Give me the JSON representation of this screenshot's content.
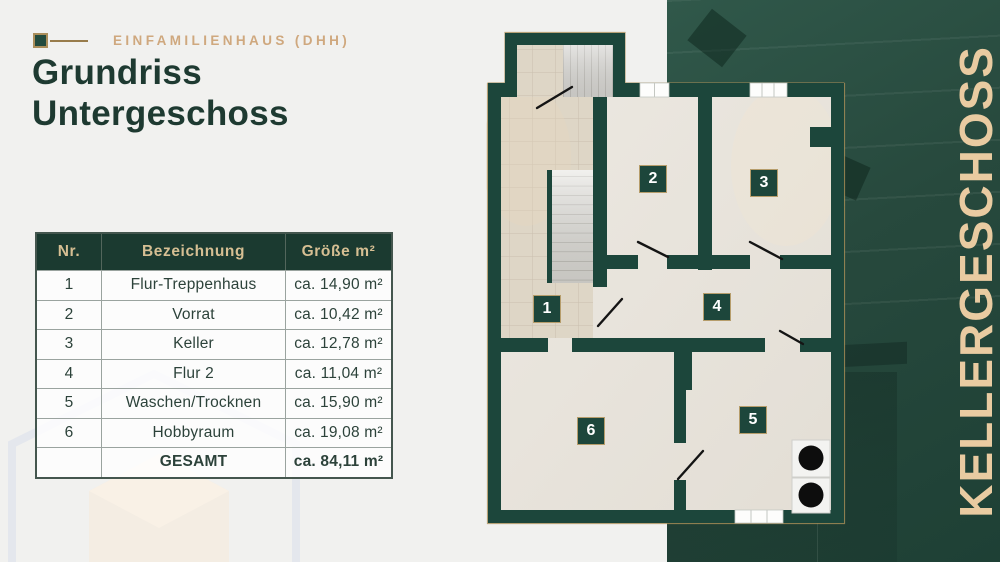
{
  "header": {
    "eyebrow": "EINFAMILIENHAUS (DHH)",
    "title_line1": "Grundriss",
    "title_line2": "Untergeschoss"
  },
  "table": {
    "columns": [
      "Nr.",
      "Bezeichnung",
      "Größe m²"
    ],
    "rows": [
      {
        "nr": "1",
        "name": "Flur-Treppenhaus",
        "size": "ca. 14,90 m²"
      },
      {
        "nr": "2",
        "name": "Vorrat",
        "size": "ca. 10,42 m²"
      },
      {
        "nr": "3",
        "name": "Keller",
        "size": "ca. 12,78 m²"
      },
      {
        "nr": "4",
        "name": "Flur 2",
        "size": "ca. 11,04 m²"
      },
      {
        "nr": "5",
        "name": "Waschen/Trocknen",
        "size": "ca. 15,90 m²"
      },
      {
        "nr": "6",
        "name": "Hobbyraum",
        "size": "ca. 19,08 m²"
      }
    ],
    "total": {
      "label": "GESAMT",
      "size": "ca. 84,11 m²"
    }
  },
  "floor_plan": {
    "rooms": [
      {
        "number": "1"
      },
      {
        "number": "2"
      },
      {
        "number": "3"
      },
      {
        "number": "4"
      },
      {
        "number": "5"
      },
      {
        "number": "6"
      }
    ]
  },
  "side_banner": {
    "text": "KELLERGESCHOSS"
  },
  "colors": {
    "wall_green": "#1c463b",
    "title_green": "#1e3a31",
    "table_header_bg": "#1b3a30",
    "gold_eyebrow": "#cfa87e",
    "gold_banner": "#e9cba1",
    "gold_outline": "#a98e58",
    "page_bg": "#f1f1ef"
  }
}
